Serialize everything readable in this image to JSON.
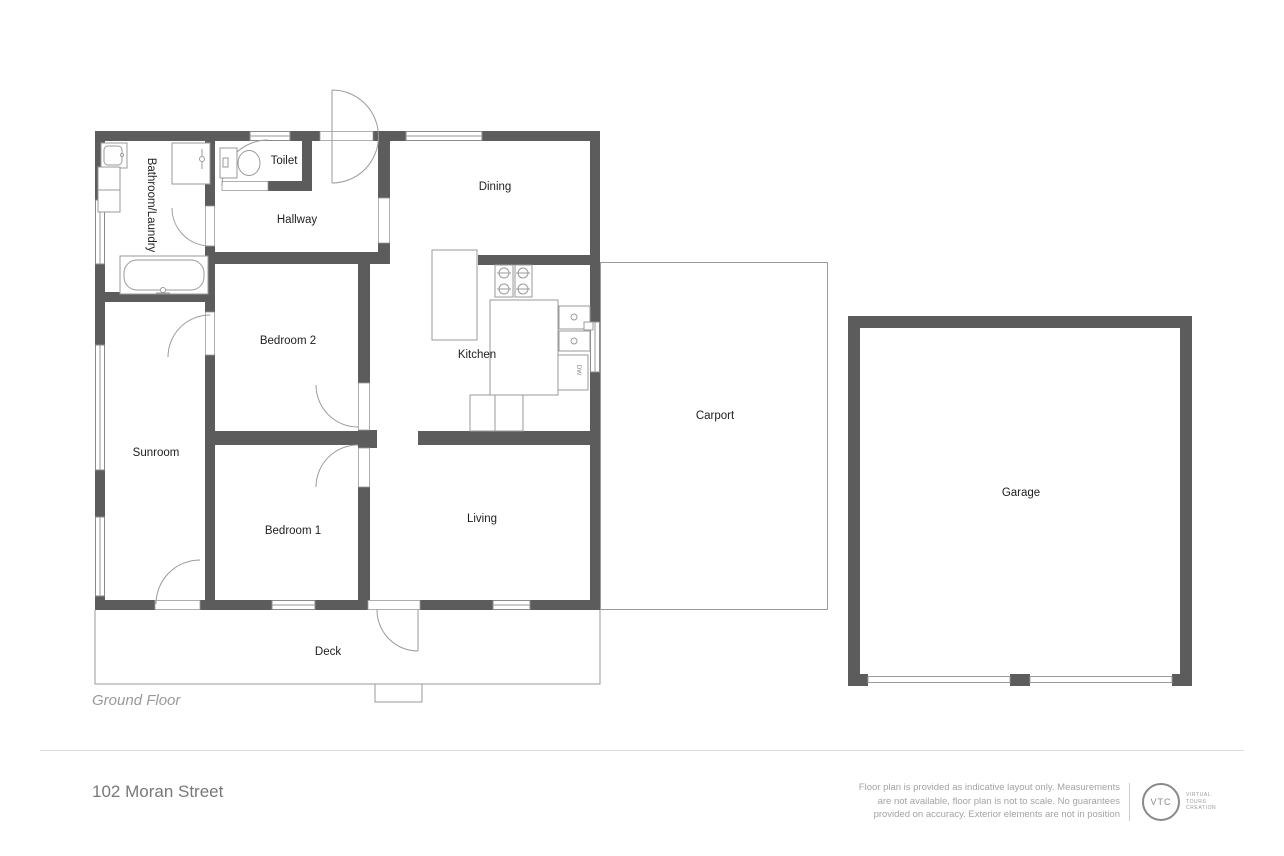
{
  "plan": {
    "floor_label": "Ground Floor",
    "rooms": [
      {
        "name": "bathroom-laundry",
        "label": "Bathroom/Laundry",
        "x": 151,
        "y": 205,
        "rotated": true
      },
      {
        "name": "toilet",
        "label": "Toilet",
        "x": 284,
        "y": 161,
        "rotated": false
      },
      {
        "name": "hallway",
        "label": "Hallway",
        "x": 297,
        "y": 220,
        "rotated": false
      },
      {
        "name": "dining",
        "label": "Dining",
        "x": 495,
        "y": 187,
        "rotated": false
      },
      {
        "name": "bedroom-2",
        "label": "Bedroom 2",
        "x": 288,
        "y": 341,
        "rotated": false
      },
      {
        "name": "kitchen",
        "label": "Kitchen",
        "x": 477,
        "y": 355,
        "rotated": false
      },
      {
        "name": "sunroom",
        "label": "Sunroom",
        "x": 156,
        "y": 453,
        "rotated": false
      },
      {
        "name": "bedroom-1",
        "label": "Bedroom 1",
        "x": 293,
        "y": 531,
        "rotated": false
      },
      {
        "name": "living",
        "label": "Living",
        "x": 482,
        "y": 519,
        "rotated": false
      },
      {
        "name": "carport",
        "label": "Carport",
        "x": 715,
        "y": 416,
        "rotated": false
      },
      {
        "name": "garage",
        "label": "Garage",
        "x": 1021,
        "y": 493,
        "rotated": false
      },
      {
        "name": "deck",
        "label": "Deck",
        "x": 328,
        "y": 652,
        "rotated": false
      }
    ],
    "fixture_labels": {
      "dishwasher": "DW"
    }
  },
  "footer": {
    "address": "102 Moran Street",
    "disclaimer_lines": [
      "Floor plan is provided as indicative layout only. Measurements",
      "are not available, floor plan is not to scale. No guarantees",
      "provided on accuracy. Exterior elements are not in position"
    ],
    "logo": {
      "abbr": "VTC",
      "name_lines": [
        "VIRTUAL",
        "TOURS",
        "CREATION"
      ]
    }
  },
  "colors": {
    "wall": "#5c5c5c",
    "thin_line": "#9a9a9a",
    "label_text": "#1e1e1e",
    "muted_text": "#9a9a9a",
    "divider": "#dddddd"
  }
}
